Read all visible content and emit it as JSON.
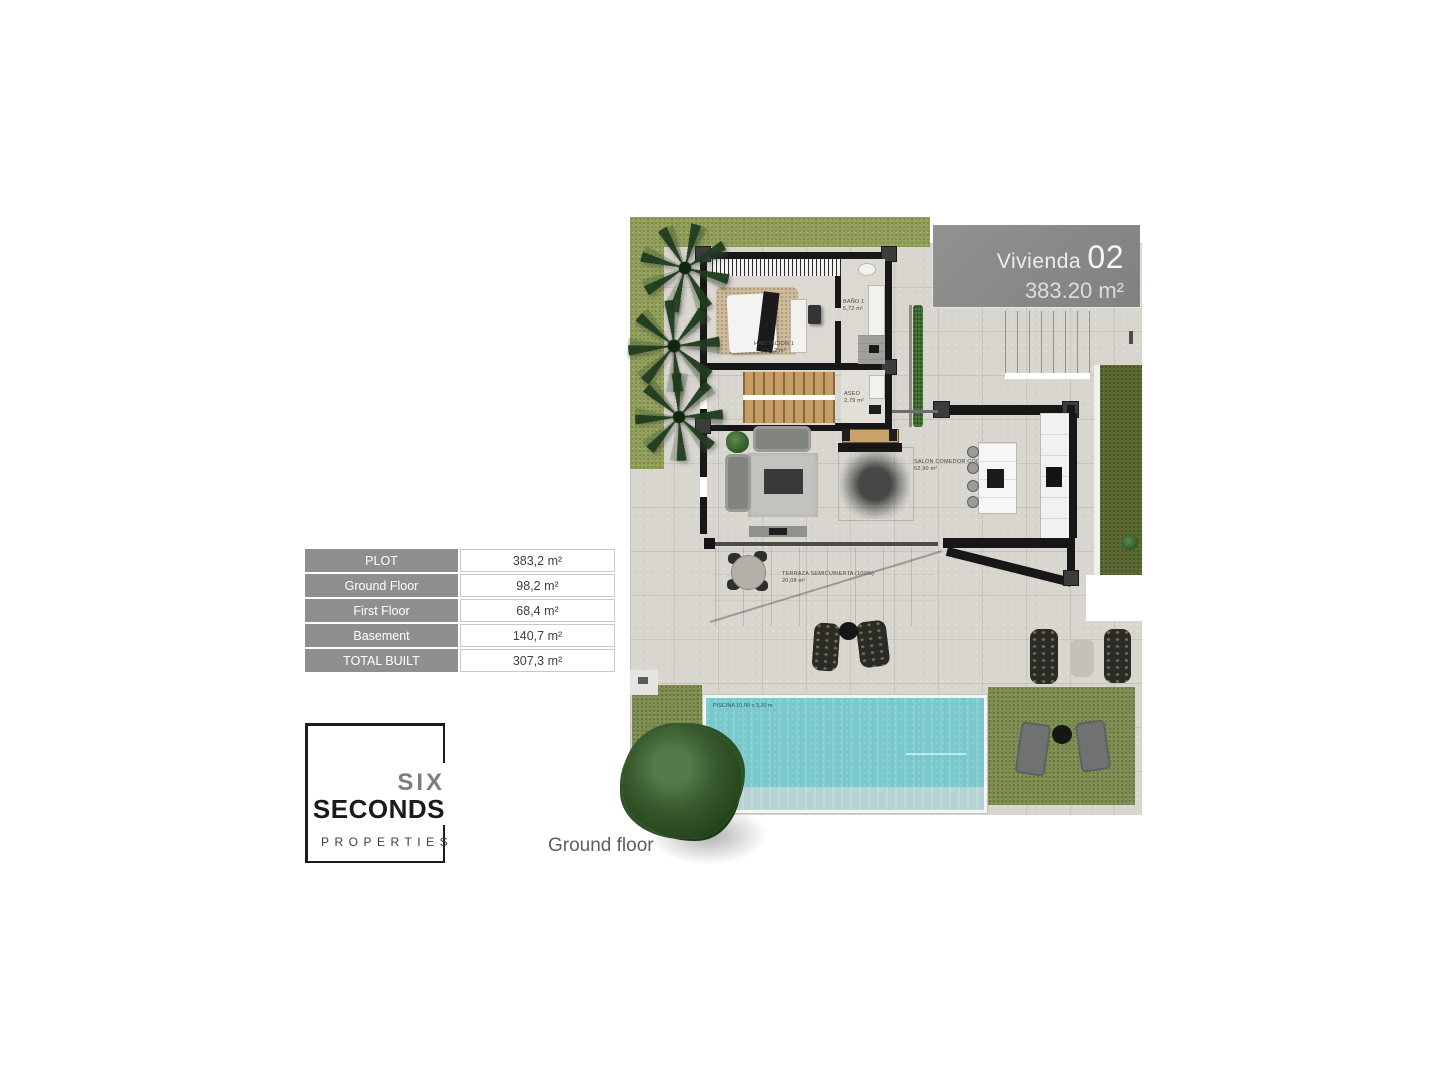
{
  "caption": "Ground floor",
  "unit_badge": {
    "title": "Vivienda",
    "number": "02",
    "area": "383.20 m²",
    "bg": "#868986"
  },
  "area_table": {
    "rows": [
      {
        "label": "PLOT",
        "value": "383,2 m²"
      },
      {
        "label": "Ground Floor",
        "value": "98,2 m²"
      },
      {
        "label": "First Floor",
        "value": "68,4 m²"
      },
      {
        "label": "Basement",
        "value": "140,7 m²"
      },
      {
        "label": "TOTAL BUILT",
        "value": "307,3 m²"
      }
    ],
    "header_bg": "#8e9090"
  },
  "logo": {
    "line1": "SIX",
    "line2": "SECONDS",
    "line3": "PROPERTIES"
  },
  "floorplan": {
    "rooms": {
      "habitacion": {
        "name": "HABITACION 1",
        "area": "13,12 m²"
      },
      "bano": {
        "name": "BAÑO 1",
        "area": "5,72 m²"
      },
      "aseo": {
        "name": "ASEO",
        "area": "2,79 m²"
      },
      "salon": {
        "name": "SALON COMEDOR COCINA",
        "area": "52,90 m²"
      },
      "terraza": {
        "name": "TERRAZA SEMICUBIERTA (100%)",
        "area": "20,08 m²"
      },
      "piscina": {
        "name": "PISCINA 10,00 x 3,20 m"
      }
    },
    "colors": {
      "pavement": "#d8d5cf",
      "grass": "#93a05c",
      "grass_dark": "#7e8d51",
      "hedge_olive": "#5c6a33",
      "pool": "#79c8cc",
      "pool_shallow": "#b7d3d5",
      "wall": "#171717",
      "wood_stairs": "#c49e66"
    }
  }
}
